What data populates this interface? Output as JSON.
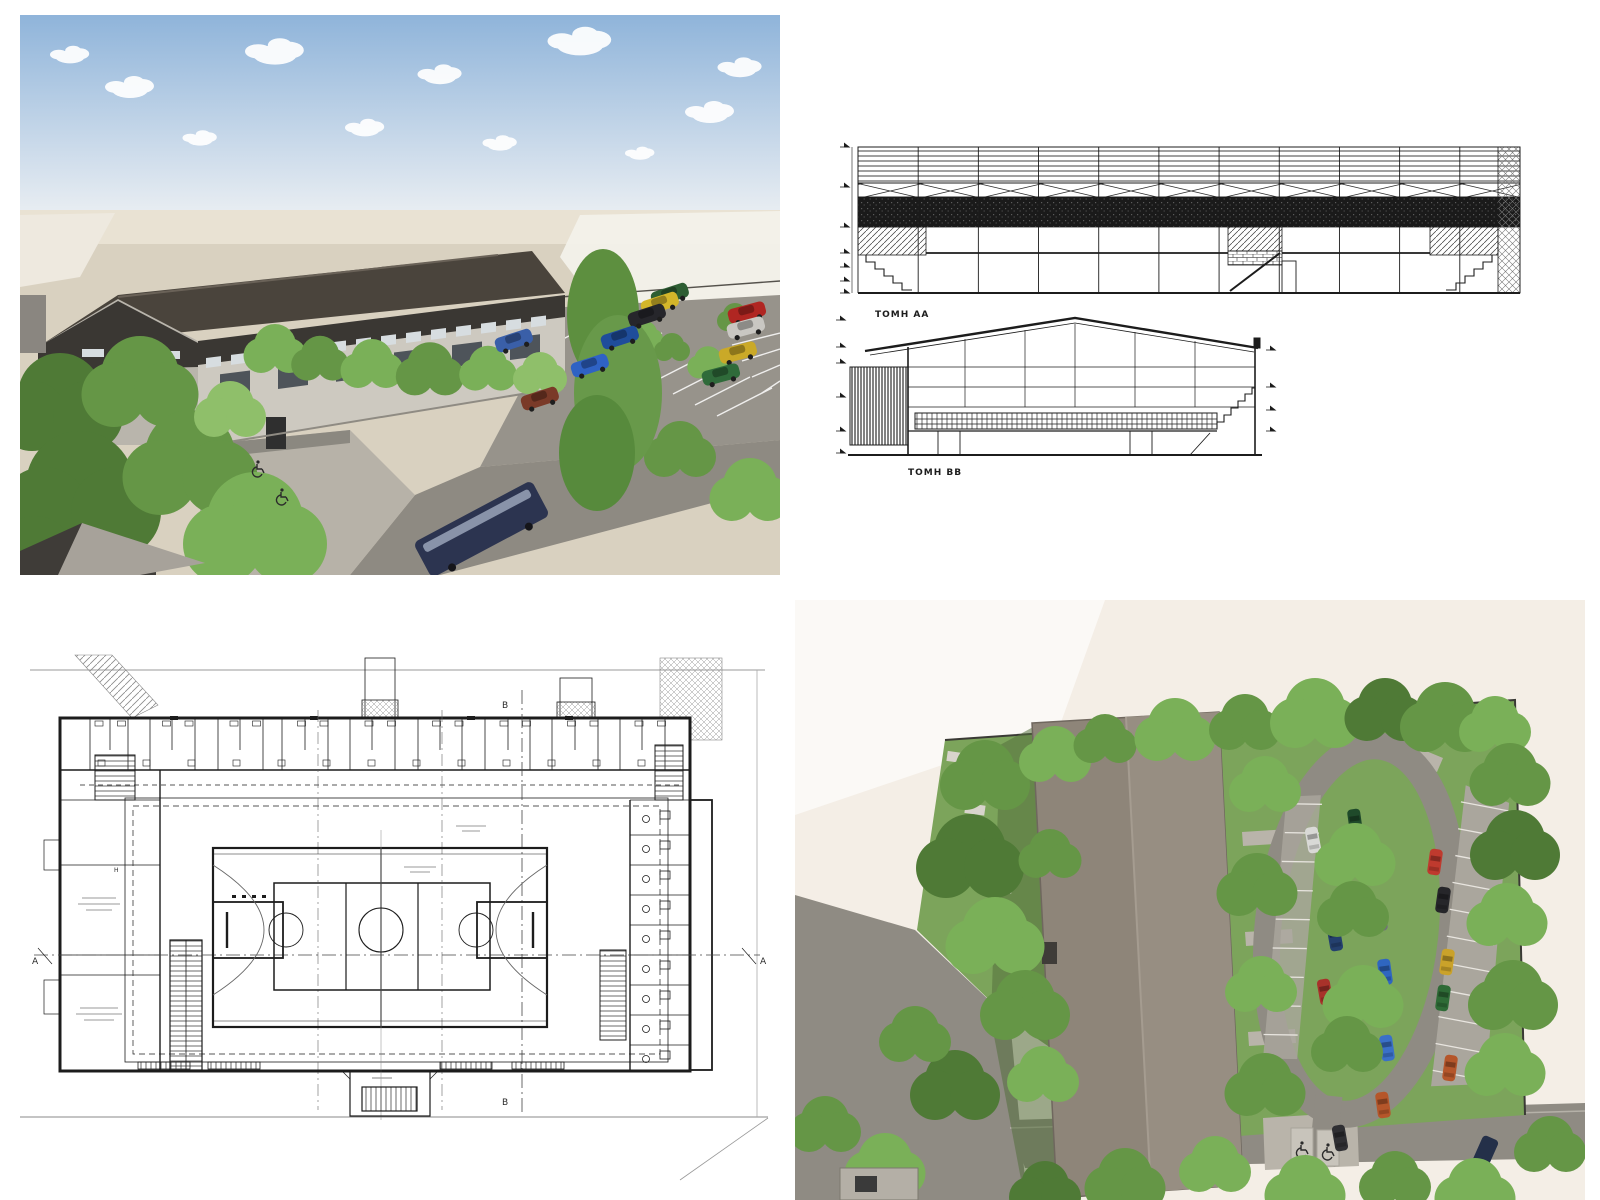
{
  "sections": {
    "label_aa": "ТОМН АА",
    "label_bb": "ТОМН ВВ"
  },
  "floor_plan": {
    "marker_a": "A",
    "marker_b": "B",
    "marker_h": "H"
  },
  "icons": {
    "wheelchair": "wheelchair-icon"
  },
  "colors": {
    "sky_top": "#8fb4da",
    "sky_horizon": "#e8edf2",
    "ground": "#d9d1c0",
    "horizon_band": "#e9e2d3",
    "far_white": "#f3f1ea",
    "roof_dark": "#4a443c",
    "roof_ridge": "#6a6258",
    "wall_light": "#cdc9c0",
    "wall_shade": "#b9b5ac",
    "band_dark": "#3a3733",
    "window_glass": "#d7dde0",
    "window_dark": "#4e545a",
    "asphalt": "#97938b",
    "road": "#8e8a82",
    "plaza": "#b7b2a8",
    "wall_retain": "#8b8880",
    "bus": "#2c3450",
    "bus_window": "#9aa4b8",
    "aerial_bg": "#f4eee6",
    "aerial_white": "#fbf9f6",
    "aerial_grass": "#7ca45b",
    "aerial_grass_light": "#8cb468",
    "aerial_road": "#8f8b83",
    "aerial_roof": "#8e8579",
    "aerial_roof_light": "#978e82",
    "aerial_path": "#b9b4aa",
    "stall_pad": "#aaa69d",
    "van": "#243049",
    "shadow_green": "#53703c",
    "drawing_line": "#1c1c1c",
    "drawing_gray": "#8a8a8a",
    "tree_greens": [
      "#4f7a36",
      "#659646",
      "#7ab058",
      "#8fbf6a"
    ],
    "cars_perspective": [
      "#2e5e33",
      "#d4b62a",
      "#26262b",
      "#1f4d9b",
      "#2f62c4",
      "#7a3a28",
      "#b02622",
      "#c9c7c2",
      "#caa928",
      "#2f6b3a",
      "#3a5fa8"
    ],
    "cars_aerial": [
      "#d9d9d6",
      "#1f4a2a",
      "#d4af2c",
      "#bf3a2e",
      "#26262a",
      "#71717a",
      "#24406e",
      "#2f66c0",
      "#a8322a",
      "#caa22a",
      "#2e6b36",
      "#2a6b62",
      "#3a70c8",
      "#b5562a",
      "#1d2a4c",
      "#2f2f33"
    ]
  }
}
